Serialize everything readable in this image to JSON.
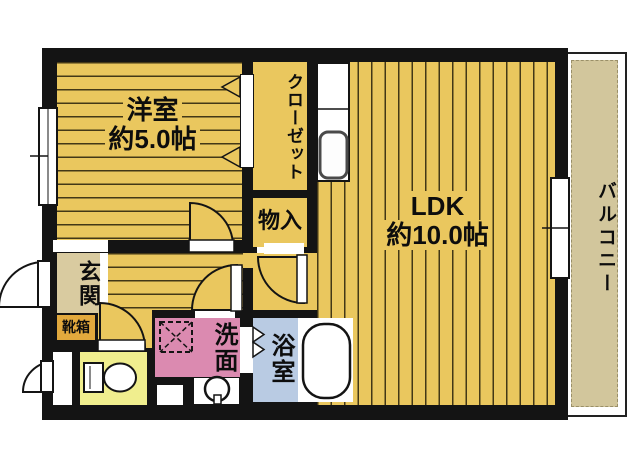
{
  "floorplan": {
    "title": "1LDK apartment floor plan",
    "rooms": {
      "western_room": {
        "name": "洋室",
        "size": "約5.0帖"
      },
      "ldk": {
        "name": "LDK",
        "size": "約10.0帖"
      },
      "closet": {
        "name": "クローゼット"
      },
      "storage": {
        "name": "物入"
      },
      "entrance": {
        "name": "玄関"
      },
      "shoe_box": {
        "name": "靴箱"
      },
      "washroom": {
        "name": "洗面"
      },
      "bathroom": {
        "name": "浴室"
      },
      "balcony": {
        "name": "バルコニー"
      }
    },
    "colors": {
      "wall": "#141414",
      "room_yellow": "#eac75e",
      "entrance_beige": "#d9cba0",
      "shoebox_orange": "#e2a93d",
      "toilet_yellow": "#f0ee8e",
      "washroom_pink": "#db8ab0",
      "bathroom_blue": "#b9cbe3",
      "balcony_beige": "#d2c69c"
    }
  }
}
